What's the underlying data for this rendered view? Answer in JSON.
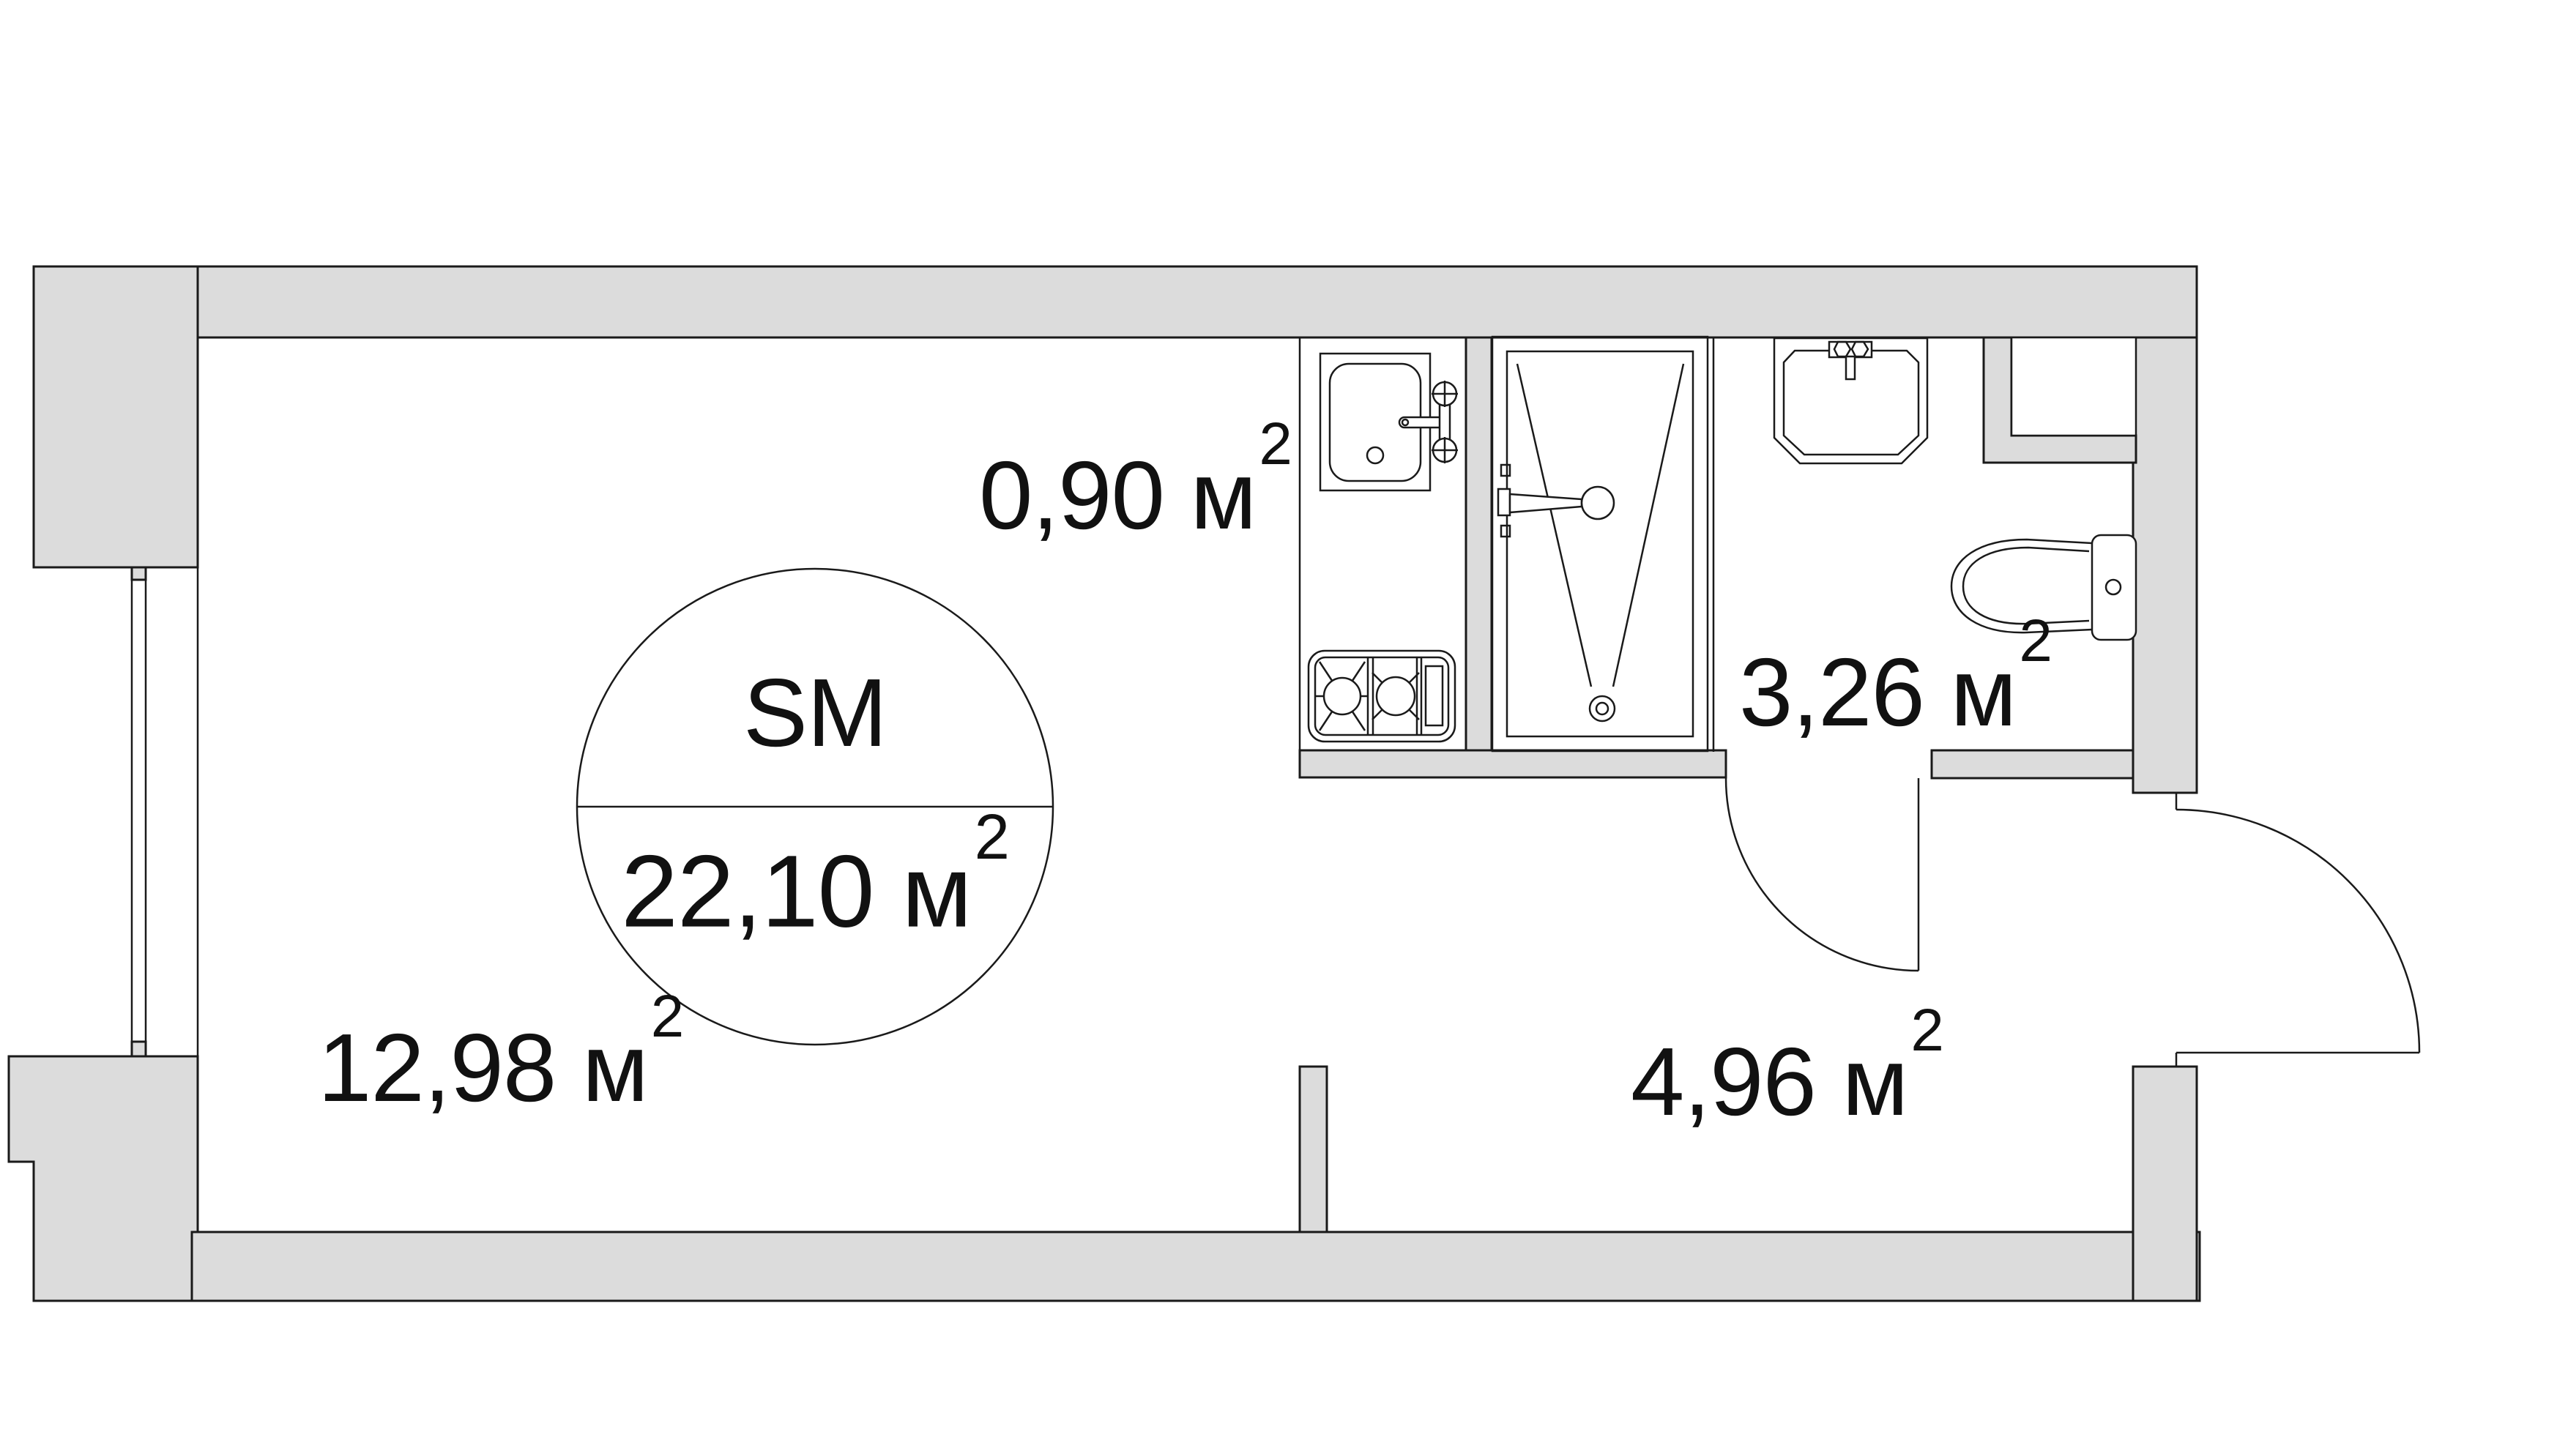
{
  "colors": {
    "background": "#ffffff",
    "wall_fill": "#dcdcdc",
    "line": "#1a1a1a",
    "text": "#111111"
  },
  "unit_badge": {
    "type_label": "SM",
    "total_area": "22,10 м",
    "total_area_sup": "2"
  },
  "rooms": [
    {
      "key": "kitchen-niche",
      "area": "0,90 м",
      "sup": "2"
    },
    {
      "key": "bathroom",
      "area": "3,26 м",
      "sup": "2"
    },
    {
      "key": "living-room",
      "area": "12,98 м",
      "sup": "2"
    },
    {
      "key": "hallway",
      "area": "4,96 м",
      "sup": "2"
    }
  ]
}
